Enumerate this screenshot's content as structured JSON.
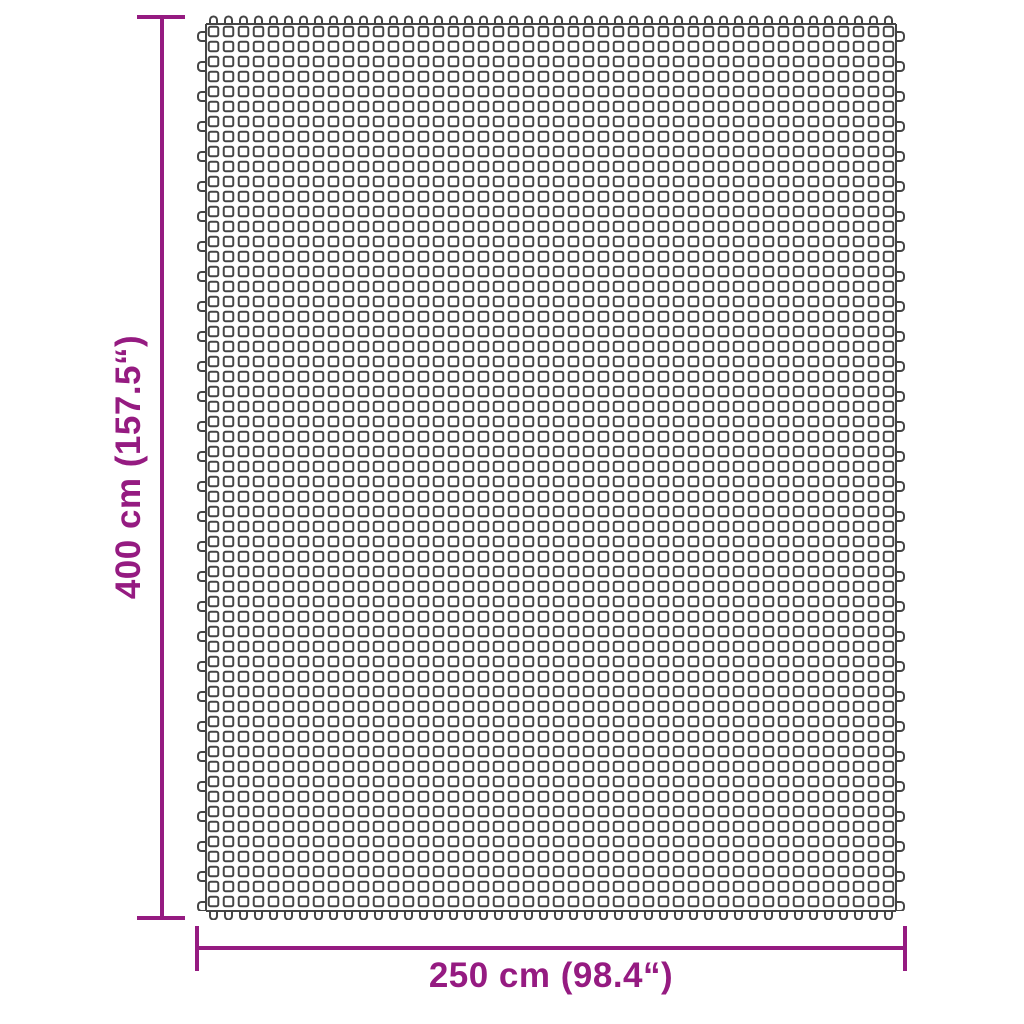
{
  "diagram": {
    "type": "product-dimension-diagram",
    "subject": "rectangular grid mat (mesh ground sheet)",
    "vertical_dimension": {
      "label": "400 cm (157.5“)"
    },
    "horizontal_dimension": {
      "label": "250 cm (98.4“)"
    },
    "colors": {
      "dimension": "#951b81",
      "grid": "#454545",
      "background": "#ffffff"
    }
  }
}
